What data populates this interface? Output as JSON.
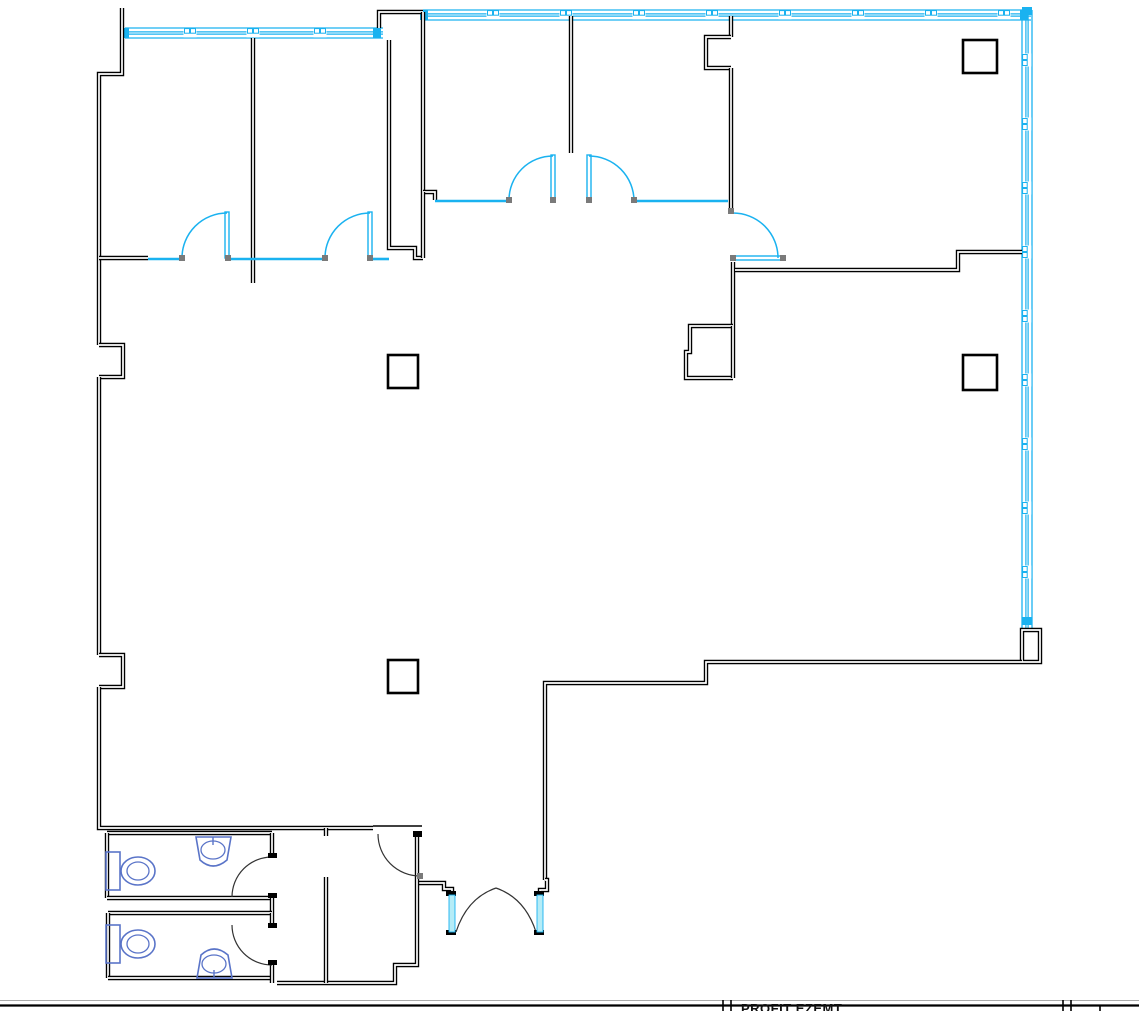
{
  "canvas": {
    "width": 1139,
    "height": 1011
  },
  "colors": {
    "wall": "#000000",
    "wall_core": "#ffffff",
    "glazing": "#1ab2f0",
    "glazing_pale": "#b5ecf7",
    "fixture": "#5a74c8",
    "door_stop": "#7a7a7a",
    "door_arc_dark": "#333333",
    "sheet_line": "#aaaaaa"
  },
  "title_block": {
    "label": "PROFIT EZEMT",
    "label_x": 741,
    "label_y": 1001,
    "border_line_y": 1005.5,
    "faint_line_y": 1000.5,
    "dividers": [
      {
        "x": 723,
        "y1": 1000,
        "y2": 1011
      },
      {
        "x": 731,
        "y1": 1000,
        "y2": 1011
      },
      {
        "x": 1063,
        "y1": 1000,
        "y2": 1011
      },
      {
        "x": 1071,
        "y1": 1000,
        "y2": 1011
      },
      {
        "x": 1100,
        "y1": 1005,
        "y2": 1011
      }
    ]
  },
  "plan": {
    "dwalls": [
      [
        [
          122,
          8
        ],
        [
          122,
          74
        ],
        [
          99,
          74
        ],
        [
          99,
          345
        ]
      ],
      [
        [
          99,
          345
        ],
        [
          123,
          345
        ],
        [
          123,
          377
        ],
        [
          99,
          377
        ]
      ],
      [
        [
          99,
          377
        ],
        [
          99,
          655
        ]
      ],
      [
        [
          99,
          655
        ],
        [
          123,
          655
        ],
        [
          123,
          687
        ],
        [
          99,
          687
        ]
      ],
      [
        [
          99,
          687
        ],
        [
          99,
          828
        ],
        [
          373,
          828
        ]
      ],
      [
        [
          379,
          28
        ],
        [
          379,
          12
        ],
        [
          423,
          12
        ]
      ],
      [
        [
          253,
          38
        ],
        [
          253,
          283
        ]
      ],
      [
        [
          389,
          40
        ],
        [
          389,
          248
        ],
        [
          415,
          248
        ],
        [
          415,
          258
        ],
        [
          423,
          258
        ]
      ],
      [
        [
          423,
          12
        ],
        [
          423,
          192
        ]
      ],
      [
        [
          423,
          192
        ],
        [
          435,
          192
        ],
        [
          435,
          200
        ]
      ],
      [
        [
          423,
          192
        ],
        [
          423,
          258
        ]
      ],
      [
        [
          99,
          258
        ],
        [
          148,
          258
        ]
      ],
      [
        [
          571,
          16
        ],
        [
          571,
          153
        ]
      ],
      [
        [
          731,
          16
        ],
        [
          731,
          37
        ]
      ],
      [
        [
          731,
          37
        ],
        [
          706,
          37
        ],
        [
          706,
          68
        ],
        [
          731,
          68
        ]
      ],
      [
        [
          731,
          68
        ],
        [
          731,
          210
        ]
      ],
      [
        [
          733,
          262
        ],
        [
          733,
          326
        ]
      ],
      [
        [
          733,
          326
        ],
        [
          690,
          326
        ],
        [
          690,
          352
        ],
        [
          686,
          352
        ],
        [
          686,
          378
        ],
        [
          733,
          378
        ]
      ],
      [
        [
          733,
          378
        ],
        [
          733,
          326
        ]
      ],
      [
        [
          735,
          270
        ],
        [
          958,
          270
        ],
        [
          958,
          252
        ],
        [
          1022,
          252
        ]
      ],
      [
        [
          1022,
          662
        ],
        [
          1022,
          630
        ],
        [
          1040,
          630
        ],
        [
          1040,
          662
        ],
        [
          1022,
          662
        ]
      ],
      [
        [
          1022,
          662
        ],
        [
          706,
          662
        ],
        [
          706,
          683
        ],
        [
          545,
          683
        ],
        [
          545,
          880
        ]
      ],
      [
        [
          545,
          880
        ],
        [
          547,
          880
        ],
        [
          547,
          890
        ],
        [
          540,
          890
        ],
        [
          540,
          897
        ]
      ],
      [
        [
          452,
          897
        ],
        [
          452,
          889
        ],
        [
          444,
          889
        ],
        [
          444,
          883
        ],
        [
          417,
          883
        ]
      ],
      [
        [
          417,
          833
        ],
        [
          417,
          877
        ]
      ],
      [
        [
          417,
          877
        ],
        [
          417,
          965
        ],
        [
          395,
          965
        ],
        [
          395,
          983
        ],
        [
          277,
          983
        ]
      ],
      [
        [
          107,
          833
        ],
        [
          272,
          833
        ]
      ],
      [
        [
          107,
          833
        ],
        [
          107,
          898
        ]
      ],
      [
        [
          107,
          898
        ],
        [
          272,
          898
        ]
      ],
      [
        [
          272,
          833
        ],
        [
          272,
          857
        ]
      ],
      [
        [
          272,
          895
        ],
        [
          272,
          913
        ]
      ],
      [
        [
          108,
          913
        ],
        [
          272,
          913
        ]
      ],
      [
        [
          108,
          913
        ],
        [
          108,
          978
        ]
      ],
      [
        [
          108,
          978
        ],
        [
          272,
          978
        ]
      ],
      [
        [
          272,
          913
        ],
        [
          272,
          927
        ]
      ],
      [
        [
          272,
          963
        ],
        [
          272,
          983
        ]
      ],
      [
        [
          326,
          877
        ],
        [
          326,
          983
        ]
      ],
      [
        [
          326,
          828
        ],
        [
          326,
          836
        ]
      ]
    ],
    "walls_thin": [
      [
        [
          373,
          826
        ],
        [
          422,
          826
        ]
      ]
    ],
    "sills": [
      [
        [
          148,
          259
        ],
        [
          182,
          259
        ]
      ],
      [
        [
          231,
          259
        ],
        [
          325,
          259
        ]
      ],
      [
        [
          373,
          259
        ],
        [
          389,
          259
        ]
      ],
      [
        [
          435,
          201
        ],
        [
          509,
          201
        ]
      ],
      [
        [
          633,
          201
        ],
        [
          728,
          201
        ]
      ]
    ],
    "leaves": [
      {
        "x": 225,
        "y": 212,
        "w": 4,
        "h": 46
      },
      {
        "x": 368,
        "y": 212,
        "w": 4,
        "h": 46
      },
      {
        "x": 551,
        "y": 155,
        "w": 4,
        "h": 45
      },
      {
        "x": 587,
        "y": 155,
        "w": 4,
        "h": 45
      },
      {
        "x": 735,
        "y": 256,
        "w": 48,
        "h": 4
      }
    ],
    "arcs_cyan": [
      "M182,258 A45,45 0 0 1 227,213",
      "M325,258 A45,45 0 0 1 370,213",
      "M509,200 A44,44 0 0 1 553,156",
      "M589,156 A45,45 0 0 1 634,201",
      "M733,213 A45,45 0 0 1 778,258"
    ],
    "arcs_dark": [
      "M378,834 A42,42 0 0 0 420,876",
      "M272,857 A40,40 0 0 0 232,897",
      "M272,965 A40,40 0 0 1 232,925",
      "M456,932 Q467,898 496,888",
      "M536,932 Q525,898 496,888"
    ],
    "bands": [
      {
        "orient": "h",
        "x1": 125,
        "x2": 383,
        "c": 33,
        "t": 10,
        "mullions": [
          190,
          253,
          320
        ],
        "caps": [
          125,
          377
        ]
      },
      {
        "orient": "h",
        "x1": 423,
        "x2": 1031,
        "c": 15,
        "t": 10,
        "mullions": [
          493,
          566,
          639,
          712,
          785,
          858,
          931,
          1004
        ],
        "caps": [
          424,
          1024
        ]
      },
      {
        "orient": "v",
        "x1": 10,
        "x2": 628,
        "c": 1027,
        "t": 10,
        "mullions": [
          60,
          124,
          188,
          252,
          316,
          380,
          444,
          508,
          572
        ],
        "caps": [
          11,
          621
        ]
      }
    ],
    "columns": [
      {
        "x": 963,
        "y": 40,
        "w": 34,
        "h": 33
      },
      {
        "x": 388,
        "y": 355,
        "w": 30,
        "h": 33
      },
      {
        "x": 963,
        "y": 355,
        "w": 34,
        "h": 35
      },
      {
        "x": 388,
        "y": 660,
        "w": 30,
        "h": 33
      }
    ],
    "stops": [
      {
        "x": 179,
        "y": 255
      },
      {
        "x": 225,
        "y": 255
      },
      {
        "x": 322,
        "y": 255
      },
      {
        "x": 367,
        "y": 255
      },
      {
        "x": 506,
        "y": 197
      },
      {
        "x": 550,
        "y": 197
      },
      {
        "x": 586,
        "y": 197
      },
      {
        "x": 631,
        "y": 197
      },
      {
        "x": 728,
        "y": 208
      },
      {
        "x": 730,
        "y": 255
      },
      {
        "x": 780,
        "y": 255
      },
      {
        "x": 417,
        "y": 873
      }
    ],
    "caps": [
      {
        "x": 268,
        "y": 853,
        "w": 9,
        "h": 5
      },
      {
        "x": 268,
        "y": 893,
        "w": 9,
        "h": 5
      },
      {
        "x": 268,
        "y": 923,
        "w": 9,
        "h": 5
      },
      {
        "x": 268,
        "y": 960,
        "w": 9,
        "h": 5
      },
      {
        "x": 413,
        "y": 831,
        "w": 9,
        "h": 6
      },
      {
        "x": 446,
        "y": 891,
        "w": 10,
        "h": 5
      },
      {
        "x": 534,
        "y": 891,
        "w": 10,
        "h": 5
      },
      {
        "x": 446,
        "y": 930,
        "w": 10,
        "h": 5
      },
      {
        "x": 534,
        "y": 930,
        "w": 10,
        "h": 5
      }
    ],
    "sidelights": [
      {
        "x": 449,
        "y": 895,
        "w": 6,
        "h": 37
      },
      {
        "x": 537,
        "y": 895,
        "w": 6,
        "h": 37
      }
    ],
    "toilets": [
      {
        "tank": {
          "x": 106,
          "y": 852,
          "w": 14,
          "h": 38
        },
        "cx": 138,
        "cy": 871,
        "rx": 17,
        "ry": 14,
        "irx": 11,
        "iry": 9
      },
      {
        "tank": {
          "x": 106,
          "y": 925,
          "w": 14,
          "h": 38
        },
        "cx": 138,
        "cy": 944,
        "rx": 17,
        "ry": 14,
        "irx": 11,
        "iry": 9
      }
    ],
    "sinks": [
      {
        "body": "M196,837 L231,837 L227,860 Q213,872 200,860 Z",
        "cx": 213,
        "cy": 850,
        "rx": 12,
        "ry": 9,
        "tick": [
          [
            213,
            837
          ],
          [
            213,
            845
          ]
        ]
      },
      {
        "body": "M197,978 L232,978 L228,955 Q214,943 201,955 Z",
        "cx": 214,
        "cy": 964,
        "rx": 12,
        "ry": 9,
        "tick": [
          [
            214,
            978
          ],
          [
            214,
            970
          ]
        ]
      }
    ]
  }
}
